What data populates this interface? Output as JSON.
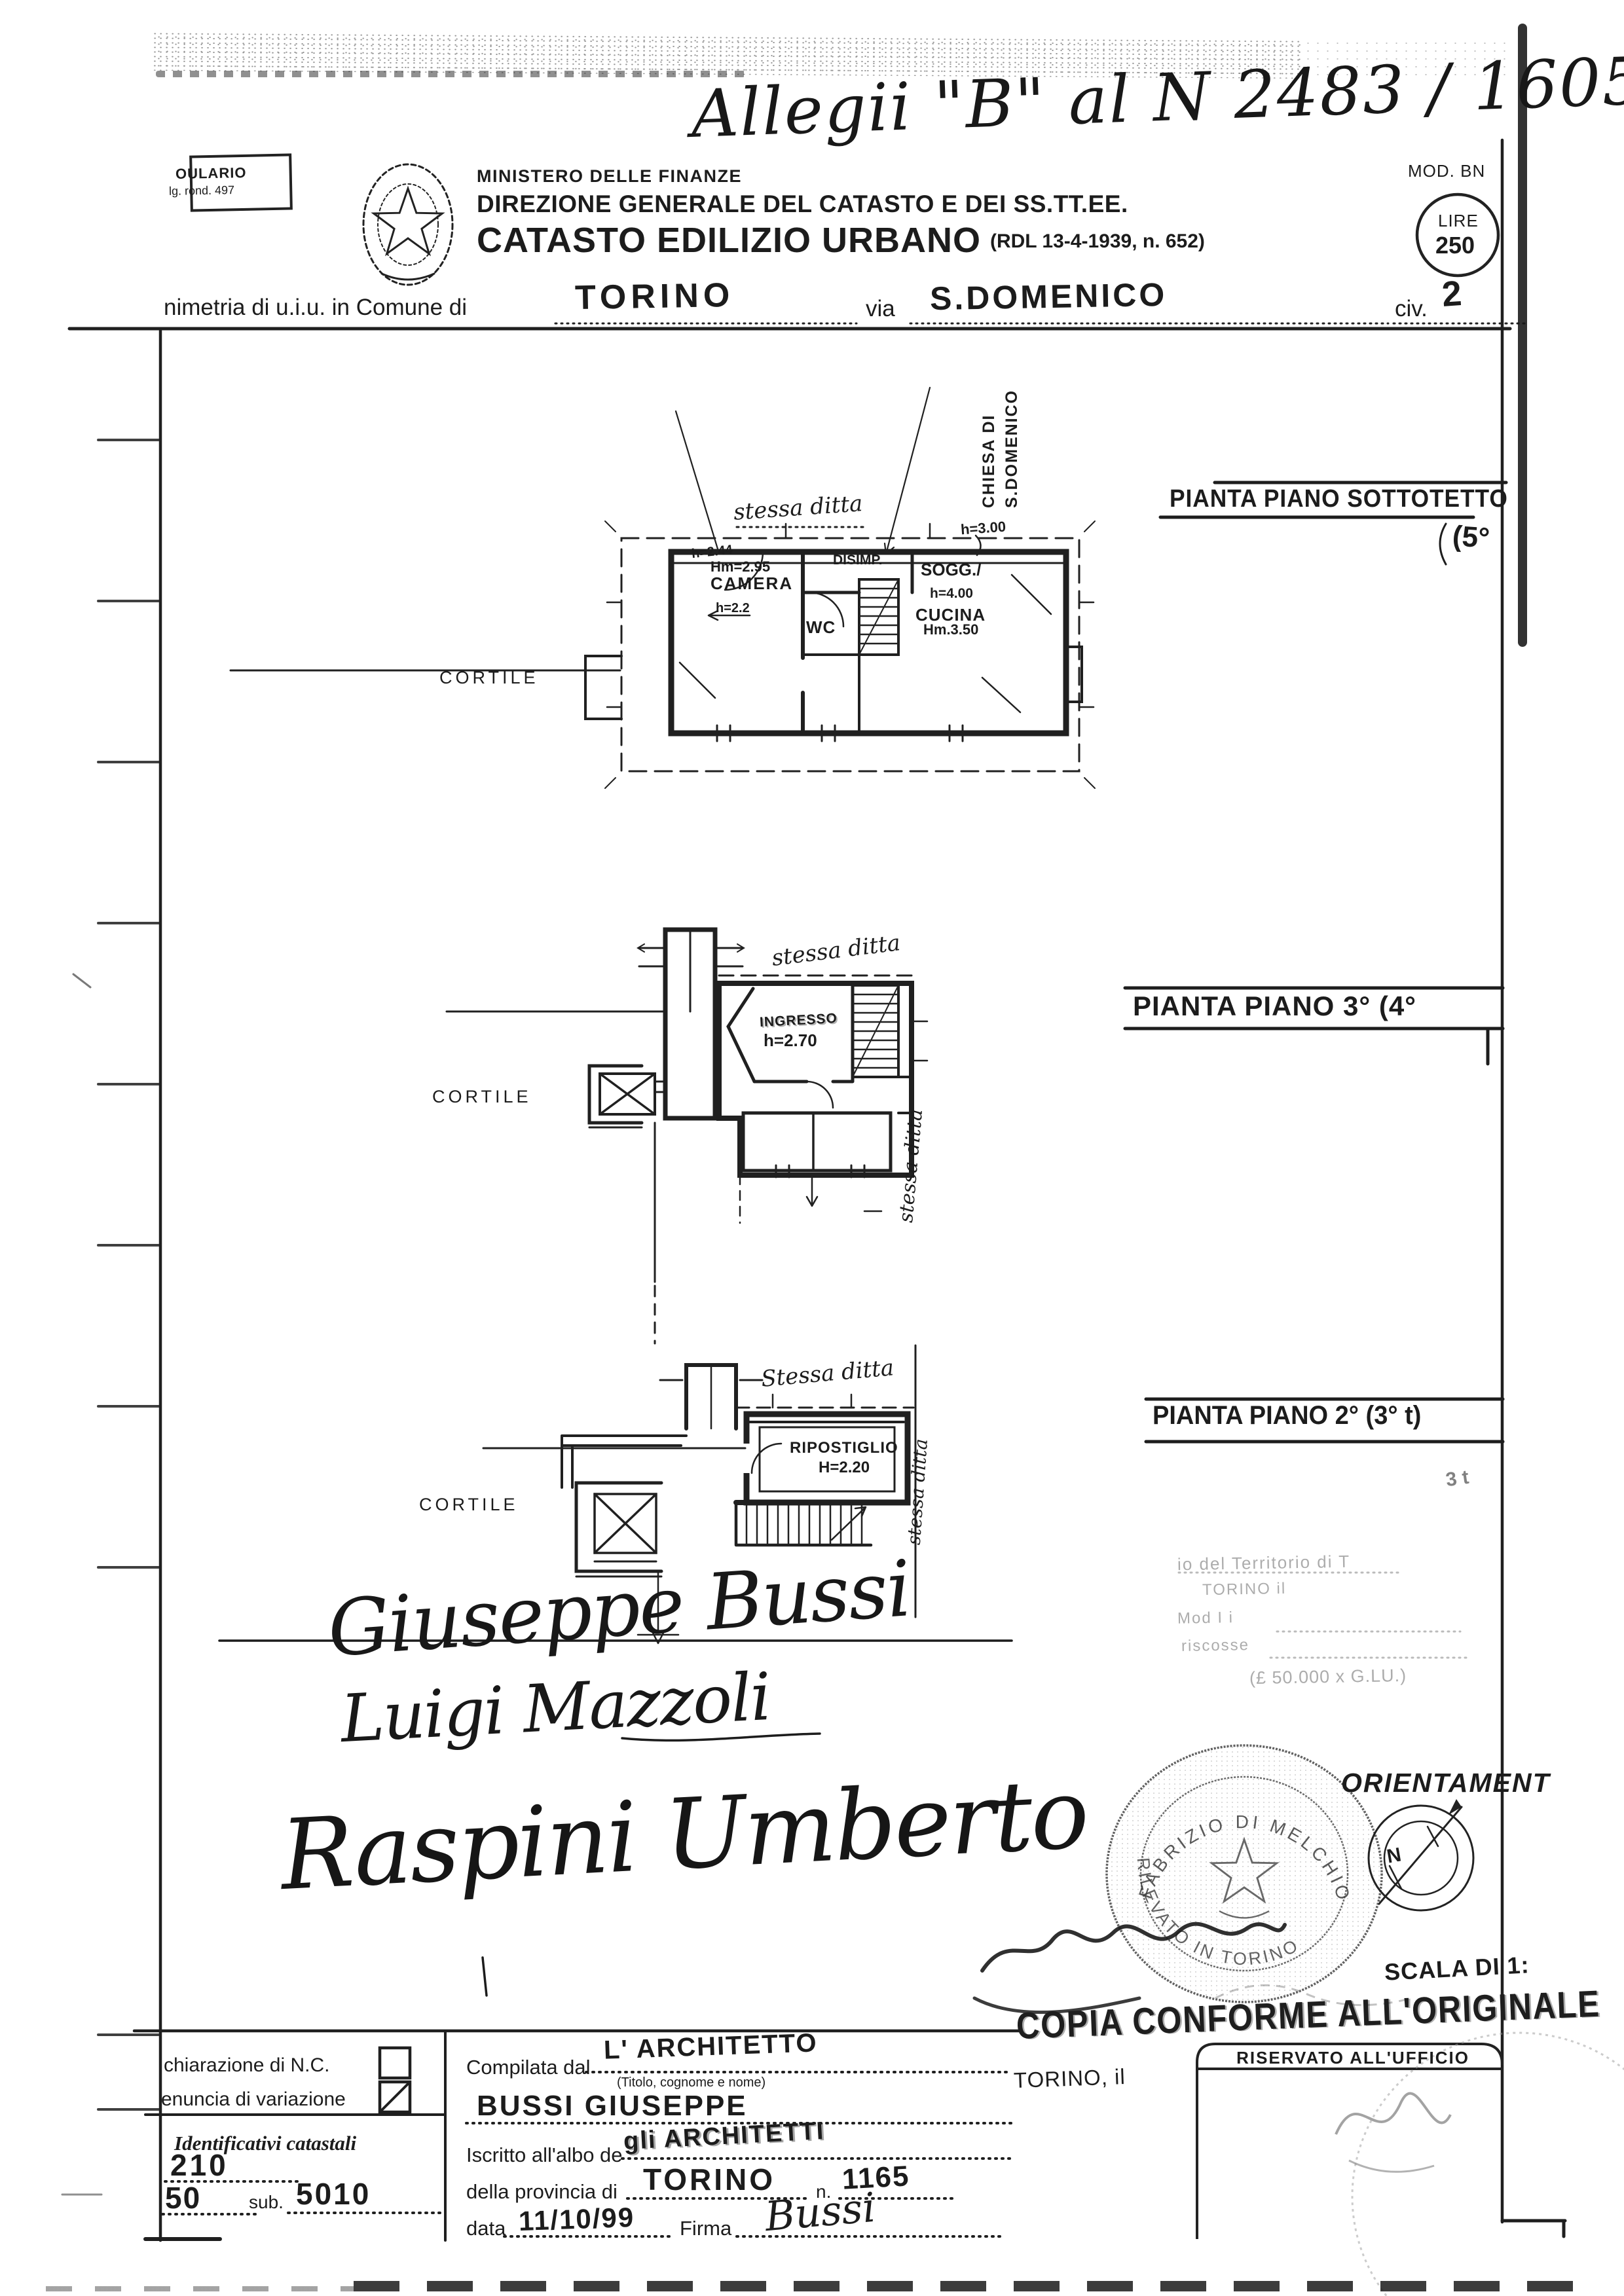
{
  "doc": {
    "annotation": "Allegii \"B\" al N 2483 / 1605 G.",
    "modulario1": "OULARIO",
    "modulario2": "lg. rond. 497",
    "ministry": "MINISTERO DELLE FINANZE",
    "directorate": "DIREZIONE GENERALE DEL CATASTO E DEI SS.TT.EE.",
    "title": "CATASTO EDILIZIO URBANO",
    "title_ref": "(RDL 13-4-1939, n. 652)",
    "mod": "MOD. BN",
    "lire_label": "LIRE",
    "lire_value": "250",
    "loc_prefix": "nimetria di u.i.u. in Comune di",
    "comune": "TORINO",
    "via_label": "via",
    "via_value": "S.DOMENICO",
    "civ_label": "civ.",
    "civ_value": "2"
  },
  "plans": [
    {
      "title": "PIANTA PIANO SOTTOTETTO",
      "floor_note": "(5°",
      "boundary_label": "stessa ditta",
      "side_label_1": "CHIESA DI",
      "side_label_2": "S.DOMENICO",
      "courtyard": "CORTILE",
      "camera": "CAMERA",
      "camera_hm": "Hm=2.95",
      "camera_h_top": "h=2.44",
      "camera_h_low": "h=2.2",
      "disimp": "DISIMP.",
      "wc": "WC",
      "sogg": "SOGG./",
      "sogg_h": "h=4.00",
      "cucina": "CUCINA",
      "cucina_h": "Hm.3.50",
      "eaves_h": "h=3.00"
    },
    {
      "title": "PIANTA PIANO 3° (4°",
      "boundary_label": "stessa ditta",
      "side_label": "stessa ditta",
      "courtyard": "CORTILE",
      "ingresso": "INGRESSO",
      "ingresso_h": "h=2.70"
    },
    {
      "title": "PIANTA PIANO 2° (3° t)",
      "floor_note": "3 t",
      "boundary_label": "Stessa ditta",
      "side_label": "stessa ditta",
      "courtyard": "CORTILE",
      "ripostiglio": "RIPOSTIGLIO",
      "ripostiglio_h": "H=2.20"
    }
  ],
  "terr": {
    "l1": "io del Territorio di T",
    "l2": "TORINO il",
    "l3": "Mod I      i",
    "l4": "riscosse",
    "l5": "(£ 50.000 x G.LU.)"
  },
  "sigs": {
    "sig1": "Giuseppe Bussi",
    "sig2": "Luigi Mazzoli",
    "sig3": "Raspini Umberto"
  },
  "right": {
    "orientamento": "ORIENTAMENT",
    "compass_n": "N",
    "scala": "SCALA DI 1:",
    "stamp_top": "FABRIZIO DI MELCHIORRE",
    "stamp_bottom": "RILEVATO IN TORINO",
    "copia": "COPIA CONFORME ALL'ORIGINALE",
    "riservato": "RISERVATO ALL'UFFICIO",
    "torino_il": "TORINO, il"
  },
  "form": {
    "dich": "chiarazione di N.C.",
    "var": "enuncia di variazione",
    "ident": "Identificativi catastali",
    "foglio": "210",
    "part": "50",
    "sub_label": "sub.",
    "sub": "5010",
    "comp_label": "Compilata dal",
    "comp": "L' ARCHITETTO",
    "titolo": "(Titolo, cognome e nome)",
    "nome": "BUSSI GIUSEPPE",
    "iscr_label": "Iscritto all'albo de",
    "iscr": "gli ARCHITETTI",
    "prov_label": "della provincia di",
    "prov": "TORINO",
    "n_label": "n.",
    "n": "1165",
    "data_label": "data",
    "data": "11/10/99",
    "firma_label": "Firma",
    "firma": "Bussi"
  }
}
